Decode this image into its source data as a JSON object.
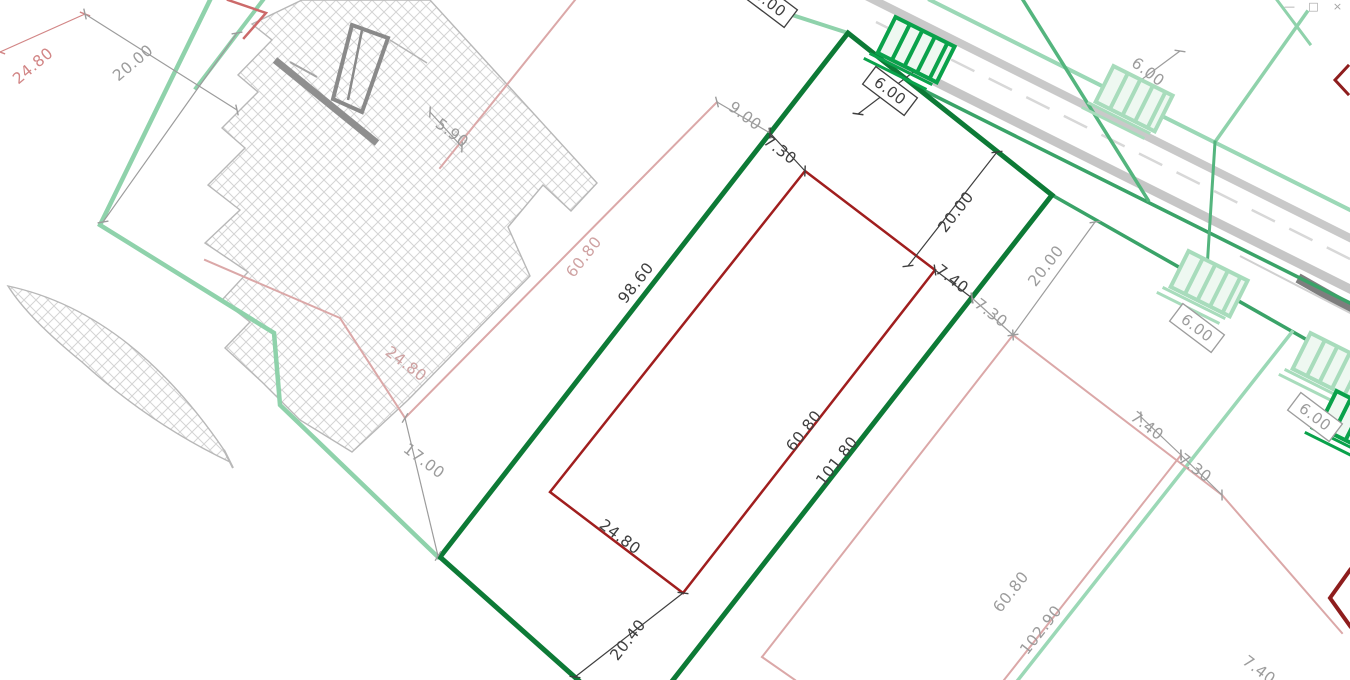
{
  "app": {
    "window_controls": [
      {
        "name": "minimize",
        "glyph": "—"
      },
      {
        "name": "restore",
        "glyph": "□"
      },
      {
        "name": "close",
        "glyph": "×"
      }
    ]
  },
  "plan": {
    "colors": {
      "background": "#ffffff",
      "hatch_line": "#d4d4d4",
      "hatch_edge": "#b8b8b8",
      "dark_green": "#0d7a36",
      "medium_green": "#3aa368",
      "soft_green": "#54b57e",
      "light_green": "#8fd2ab",
      "pale_green": "#9bd8b6",
      "crossing_vivid": "#0aa24b",
      "crossing_light": "#a8dcbc",
      "crossing_fill": "#eef8f1",
      "dark_red": "#a01e1e",
      "chevron_red": "#8e1d1d",
      "pink": "#dba8a8",
      "light_red": "#cc6a6a",
      "road_gray": "#c9c9c9",
      "road_dark": "#7e7e7e",
      "dim_black": "#3f3f3f",
      "dim_gray": "#9c9c9c",
      "dim_pink": "#cfa2a2",
      "dim_red": "#d28686"
    },
    "label_styles": {
      "black": "#3f3f3f",
      "gray": "#9c9c9c",
      "pink": "#cfa2a2",
      "red": "#d28686"
    },
    "hatch_areas": [
      {
        "name": "hatch-strip",
        "d": "M302,0 L430,0 L597,183 L571,211 L543,185 L508,227 L530,276 L455,352 L408,400 L352,452 L300,420 L262,382 L225,348 L250,322 L222,300 L248,272 L205,243 L240,210 L208,185 L245,148 L222,128 L258,92 L238,75 L272,40 L252,24 Z"
      },
      {
        "name": "hatch-triangle",
        "d": "M8,286 Q130,312 224,450 L230,462 Q150,424 82,362 Q28,318 8,286 Z"
      }
    ],
    "structure": [
      {
        "name": "monument-bar",
        "type": "line",
        "pts": [
          275,
          60,
          377,
          143
        ],
        "color": "#8f8f8f",
        "w": 7
      },
      {
        "name": "monument-tick",
        "type": "line",
        "pts": [
          290,
          62,
          317,
          77
        ],
        "color": "#a5a5a5",
        "w": 2
      },
      {
        "name": "monument-leader",
        "type": "line",
        "pts": [
          390,
          40,
          427,
          63
        ],
        "color": "#b5b5b5",
        "w": 1.5
      },
      {
        "name": "monument-rect",
        "type": "polygon",
        "pts": [
          352,
          25,
          388,
          38,
          362,
          112,
          333,
          99
        ],
        "color": "#8a8a8a",
        "w": 4
      },
      {
        "name": "monument-inner-line",
        "type": "line",
        "pts": [
          362,
          30,
          348,
          100
        ],
        "color": "#8a8a8a",
        "w": 2.5
      },
      {
        "name": "hatch-tail",
        "type": "line",
        "pts": [
          224,
          450,
          233,
          468
        ],
        "color": "#b8b8b8",
        "w": 2
      }
    ],
    "road_lines": [
      {
        "name": "road-edge-upper",
        "pts": [
          862,
          -6,
          1360,
          243
        ],
        "color": "#c9c9c9",
        "w": 8
      },
      {
        "name": "road-centerline-dashed",
        "pts": [
          876,
          22,
          1360,
          264
        ],
        "color": "#d8d8d8",
        "w": 2.5,
        "dash": "26,16"
      },
      {
        "name": "road-edge-lower",
        "pts": [
          886,
          57,
          1360,
          294
        ],
        "color": "#c6c6c6",
        "w": 9
      },
      {
        "name": "road-dark-segment",
        "pts": [
          1298,
          278,
          1358,
          312
        ],
        "color": "#7e7e7e",
        "w": 10
      },
      {
        "name": "road-outer-thin",
        "pts": [
          1240,
          256,
          1360,
          318
        ],
        "color": "#d0d0d0",
        "w": 2
      }
    ],
    "boundaries": [
      {
        "name": "left-boundary-green",
        "pts": [
          210,
          0,
          100,
          225,
          274,
          333,
          280,
          405,
          438,
          557
        ],
        "color": "#8fd2ab",
        "w": 4.5
      },
      {
        "name": "left-boundary-green-stub",
        "pts": [
          263,
          0,
          196,
          88
        ],
        "color": "#8fd2ab",
        "w": 4
      },
      {
        "name": "top-left-frontage-green",
        "pts": [
          755,
          3,
          848,
          33
        ],
        "color": "#8fd2ab",
        "w": 4
      },
      {
        "name": "road-frontage-upper-green",
        "pts": [
          930,
          0,
          1360,
          215
        ],
        "color": "#9bd8b6",
        "w": 4
      },
      {
        "name": "road-frontage-green-1",
        "pts": [
          923,
          90,
          1360,
          308
        ],
        "color": "#3aa368",
        "w": 3.5
      },
      {
        "name": "road-frontage-green-2",
        "pts": [
          1052,
          195,
          1360,
          370
        ],
        "color": "#3aa368",
        "w": 3.5
      },
      {
        "name": "green-branch-upper",
        "pts": [
          1023,
          0,
          1148,
          200
        ],
        "color": "#54b57e",
        "w": 3.5
      },
      {
        "name": "green-branch-right",
        "pts": [
          1307,
          12,
          1215,
          142
        ],
        "color": "#8fd2ab",
        "w": 3.5
      },
      {
        "name": "green-branch-right-stub",
        "pts": [
          1277,
          0,
          1310,
          44
        ],
        "color": "#8fd2ab",
        "w": 3
      },
      {
        "name": "green-branch-crossing-road",
        "pts": [
          1215,
          142,
          1206,
          285
        ],
        "color": "#54b57e",
        "w": 3
      },
      {
        "name": "parcel2-long-side-green",
        "pts": [
          1292,
          332,
          1018,
          680
        ],
        "color": "#9bd8b6",
        "w": 3.5
      },
      {
        "name": "subject-parcel-dark-green",
        "pts": [
          440,
          557,
          848,
          33,
          1052,
          195,
          673,
          680
        ],
        "color": "#0d7a36",
        "w": 5
      },
      {
        "name": "subject-parcel-dark-green-bottom",
        "pts": [
          440,
          557,
          578,
          680
        ],
        "color": "#0d7a36",
        "w": 5
      },
      {
        "name": "inner-parcel-red",
        "pts": [
          805,
          171,
          935,
          270,
          683,
          593,
          550,
          492,
          805,
          171
        ],
        "color": "#a01e1e",
        "w": 2.5
      },
      {
        "name": "red-corner-top-left",
        "pts": [
          228,
          0,
          266,
          13,
          244,
          38
        ],
        "color": "#cc6a6a",
        "w": 2.5
      },
      {
        "name": "red-chevron-top-right",
        "pts": [
          1348,
          66,
          1335,
          80,
          1348,
          94
        ],
        "color": "#8e1d1d",
        "w": 3
      },
      {
        "name": "red-chevron-right",
        "pts": [
          1350,
          570,
          1330,
          598,
          1350,
          626
        ],
        "color": "#8e1d1d",
        "w": 4
      },
      {
        "name": "pink-line-1",
        "pts": [
          575,
          0,
          440,
          168
        ],
        "color": "#dba8a8",
        "w": 2
      },
      {
        "name": "pink-parcel0-long-side",
        "pts": [
          717,
          102,
          405,
          418
        ],
        "color": "#dba8a8",
        "w": 2
      },
      {
        "name": "pink-parcel0-short-side",
        "pts": [
          405,
          418,
          340,
          318
        ],
        "color": "#dba8a8",
        "w": 2
      },
      {
        "name": "pink-parcel0-back-side",
        "pts": [
          340,
          318,
          205,
          260
        ],
        "color": "#dba8a8",
        "w": 2
      },
      {
        "name": "pink-parcel2-front-side",
        "pts": [
          1013,
          335,
          1222,
          495
        ],
        "color": "#dba8a8",
        "w": 2
      },
      {
        "name": "pink-parcel2-left-side",
        "pts": [
          1013,
          335,
          762,
          657
        ],
        "color": "#dba8a8",
        "w": 2
      },
      {
        "name": "pink-parcel2-bottom-side",
        "pts": [
          762,
          657,
          795,
          680
        ],
        "color": "#dba8a8",
        "w": 2
      },
      {
        "name": "pink-parcel2-division",
        "pts": [
          1181,
          455,
          1004,
          680
        ],
        "color": "#dba8a8",
        "w": 2
      },
      {
        "name": "pink-parcel3-side",
        "pts": [
          1222,
          495,
          1342,
          633
        ],
        "color": "#dba8a8",
        "w": 2
      }
    ],
    "dimensions": [
      {
        "name": "dim-24-80-red",
        "pts": [
          0,
          52,
          85,
          14
        ],
        "style": "red"
      },
      {
        "name": "dim-20-00-top-left-a",
        "pts": [
          85,
          14,
          237,
          110
        ],
        "style": "gray"
      },
      {
        "name": "dim-20-00-top-left-b",
        "pts": [
          237,
          33,
          103,
          222
        ],
        "style": "gray"
      },
      {
        "name": "dim-5-90",
        "pts": [
          430,
          112,
          462,
          147
        ],
        "style": "gray"
      },
      {
        "name": "dim-9-00",
        "pts": [
          717,
          102,
          770,
          133
        ],
        "style": "gray"
      },
      {
        "name": "dim-7-30-black",
        "pts": [
          770,
          133,
          805,
          171
        ],
        "style": "black"
      },
      {
        "name": "dim-20-00-black",
        "pts": [
          997,
          152,
          908,
          266
        ],
        "style": "black"
      },
      {
        "name": "dim-7-40-black",
        "pts": [
          935,
          270,
          972,
          298
        ],
        "style": "black"
      },
      {
        "name": "dim-6-00-crossing1",
        "pts": [
          858,
          114,
          928,
          61
        ],
        "style": "black"
      },
      {
        "name": "dim-20-40",
        "pts": [
          683,
          593,
          575,
          677
        ],
        "style": "black"
      },
      {
        "name": "dim-17-00",
        "pts": [
          405,
          418,
          438,
          556
        ],
        "style": "gray"
      },
      {
        "name": "dim-20-00-right",
        "pts": [
          1095,
          222,
          1013,
          335
        ],
        "style": "gray"
      },
      {
        "name": "dim-7-30-right1",
        "pts": [
          972,
          298,
          1013,
          335
        ],
        "style": "gray"
      },
      {
        "name": "dim-6-00-crossing2",
        "pts": [
          1118,
          97,
          1180,
          51
        ],
        "style": "gray"
      },
      {
        "name": "dim-7-40-right2",
        "pts": [
          1141,
          417,
          1181,
          455
        ],
        "style": "gray"
      },
      {
        "name": "dim-7-30-right3",
        "pts": [
          1181,
          455,
          1222,
          495
        ],
        "style": "gray"
      }
    ],
    "crossing_shape": {
      "angle": 26.5,
      "outer": [
        -33,
        -27,
        66,
        40
      ],
      "rung_xs": [
        -17,
        -3,
        11,
        25
      ],
      "rung_y": [
        -27,
        13
      ],
      "foot": [
        [
          -40,
          17,
          30,
          17
        ],
        [
          -43,
          24,
          27,
          24
        ]
      ]
    },
    "crossings": [
      {
        "name": "crossing-entrance-1",
        "cx": 913,
        "cy": 56,
        "variant": "vivid"
      },
      {
        "name": "crossing-entrance-2",
        "cx": 1131,
        "cy": 105,
        "variant": "light"
      },
      {
        "name": "crossing-entrance-3",
        "cx": 1206,
        "cy": 290,
        "variant": "light"
      },
      {
        "name": "crossing-entrance-4",
        "cx": 1328,
        "cy": 372,
        "variant": "light"
      },
      {
        "name": "crossing-entrance-5",
        "cx": 1354,
        "cy": 430,
        "variant": "vivid"
      }
    ],
    "boxed_labels": [
      {
        "text": "6.00",
        "x": 890,
        "y": 91,
        "rot": 37,
        "style": "black"
      },
      {
        "text": "6.00",
        "x": 770,
        "y": 3,
        "rot": 37,
        "style": "black"
      },
      {
        "text": "6.00",
        "x": 1197,
        "y": 328,
        "rot": 37,
        "style": "gray"
      },
      {
        "text": "6.00",
        "x": 1315,
        "y": 417,
        "rot": 37,
        "style": "gray"
      }
    ],
    "labels": [
      {
        "text": "24.80",
        "x": 33,
        "y": 66,
        "rot": -40,
        "style": "red"
      },
      {
        "text": "20.00",
        "x": 133,
        "y": 63,
        "rot": -40,
        "style": "gray"
      },
      {
        "text": "5.90",
        "x": 452,
        "y": 133,
        "rot": 37,
        "style": "gray"
      },
      {
        "text": "9.00",
        "x": 745,
        "y": 116,
        "rot": 37,
        "style": "gray"
      },
      {
        "text": "7.30",
        "x": 780,
        "y": 150,
        "rot": 37,
        "style": "black"
      },
      {
        "text": "20.00",
        "x": 956,
        "y": 212,
        "rot": -52,
        "style": "black"
      },
      {
        "text": "7.40",
        "x": 952,
        "y": 279,
        "rot": 37,
        "style": "black"
      },
      {
        "text": "7.30",
        "x": 991,
        "y": 313,
        "rot": 37,
        "style": "gray"
      },
      {
        "text": "20.00",
        "x": 1046,
        "y": 266,
        "rot": -52,
        "style": "gray"
      },
      {
        "text": "6.00",
        "x": 1148,
        "y": 72,
        "rot": 37,
        "style": "gray"
      },
      {
        "text": "98.60",
        "x": 636,
        "y": 283,
        "rot": -52,
        "style": "black"
      },
      {
        "text": "60.80",
        "x": 584,
        "y": 257,
        "rot": -52,
        "style": "pink"
      },
      {
        "text": "24.80",
        "x": 406,
        "y": 364,
        "rot": 37,
        "style": "pink"
      },
      {
        "text": "17.00",
        "x": 424,
        "y": 461,
        "rot": 37,
        "style": "gray"
      },
      {
        "text": "60.80",
        "x": 804,
        "y": 431,
        "rot": -52,
        "style": "black"
      },
      {
        "text": "101.80",
        "x": 837,
        "y": 461,
        "rot": -52,
        "style": "black"
      },
      {
        "text": "24.80",
        "x": 620,
        "y": 537,
        "rot": 37,
        "style": "black"
      },
      {
        "text": "20.40",
        "x": 628,
        "y": 640,
        "rot": -52,
        "style": "black"
      },
      {
        "text": "7.40",
        "x": 1147,
        "y": 426,
        "rot": 37,
        "style": "gray"
      },
      {
        "text": "7.30",
        "x": 1195,
        "y": 468,
        "rot": 37,
        "style": "gray"
      },
      {
        "text": "60.80",
        "x": 1011,
        "y": 592,
        "rot": -52,
        "style": "gray"
      },
      {
        "text": "102.90",
        "x": 1041,
        "y": 630,
        "rot": -52,
        "style": "gray"
      },
      {
        "text": "7.40",
        "x": 1259,
        "y": 670,
        "rot": 37,
        "style": "gray"
      }
    ]
  }
}
